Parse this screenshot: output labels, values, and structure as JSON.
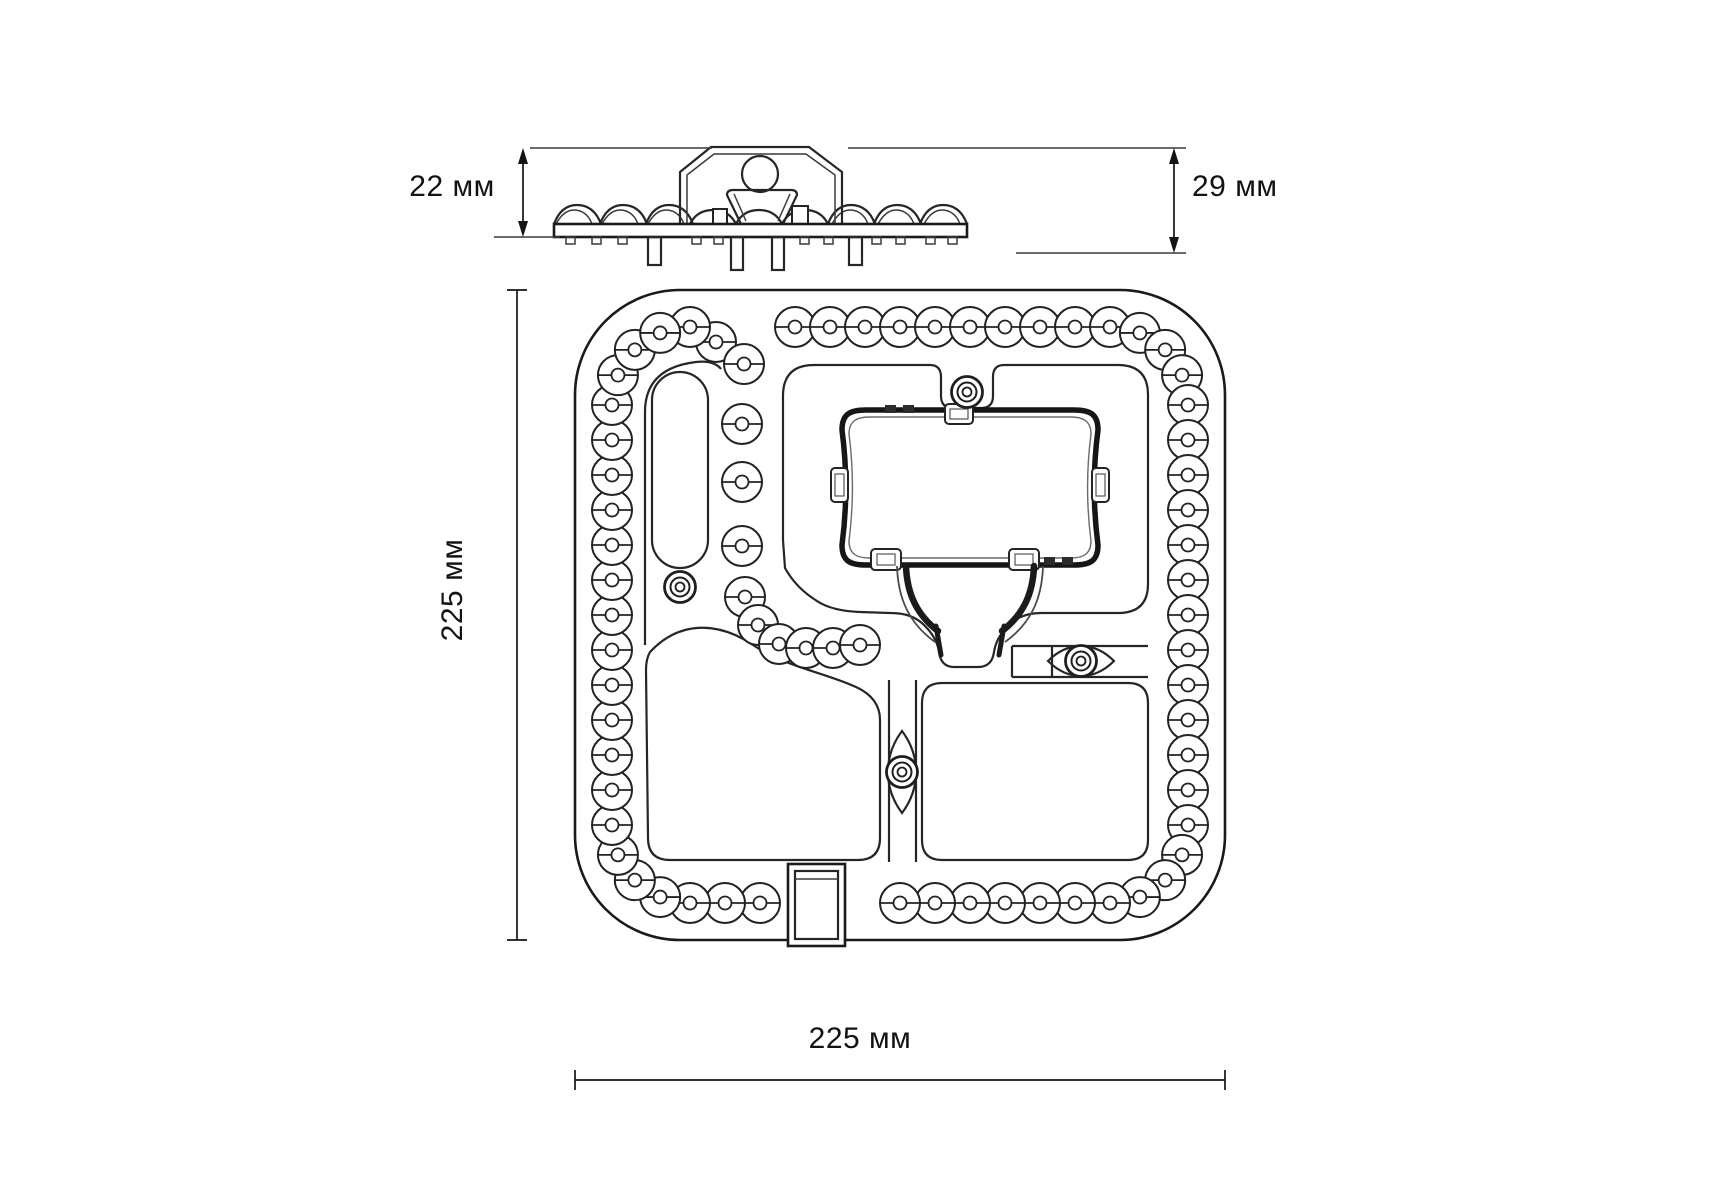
{
  "page": {
    "background": "#ffffff",
    "line_color": "#1f1f1f"
  },
  "dimensions": {
    "side_height_left": "22 мм",
    "side_height_right": "29 мм",
    "plan_height": "225 мм",
    "plan_width": "225 мм"
  },
  "plan": {
    "outer": {
      "x": 575,
      "y": 290,
      "width": 650,
      "height": 650,
      "corner_radius": 105
    },
    "led_ring": {
      "left": 612,
      "right": 1188,
      "top": 327,
      "bottom": 903,
      "corner_radius": 78,
      "leds_per_edge": 13,
      "leds_per_corner": 3,
      "lens_radius": 20,
      "inner_radius": 6.5,
      "top_gap": [
        698,
        768
      ],
      "bottom_gap": [
        768,
        868
      ]
    },
    "branch_leds": [
      [
        716,
        342
      ],
      [
        744,
        364
      ],
      [
        742,
        424
      ],
      [
        742,
        482
      ],
      [
        742,
        546
      ],
      [
        745,
        597
      ],
      [
        758,
        625
      ],
      [
        779,
        644
      ],
      [
        806,
        648
      ],
      [
        833,
        648
      ],
      [
        860,
        645
      ]
    ],
    "screw_posts": [
      [
        967,
        392
      ],
      [
        680,
        587
      ],
      [
        1081,
        661
      ],
      [
        902,
        772
      ]
    ]
  }
}
